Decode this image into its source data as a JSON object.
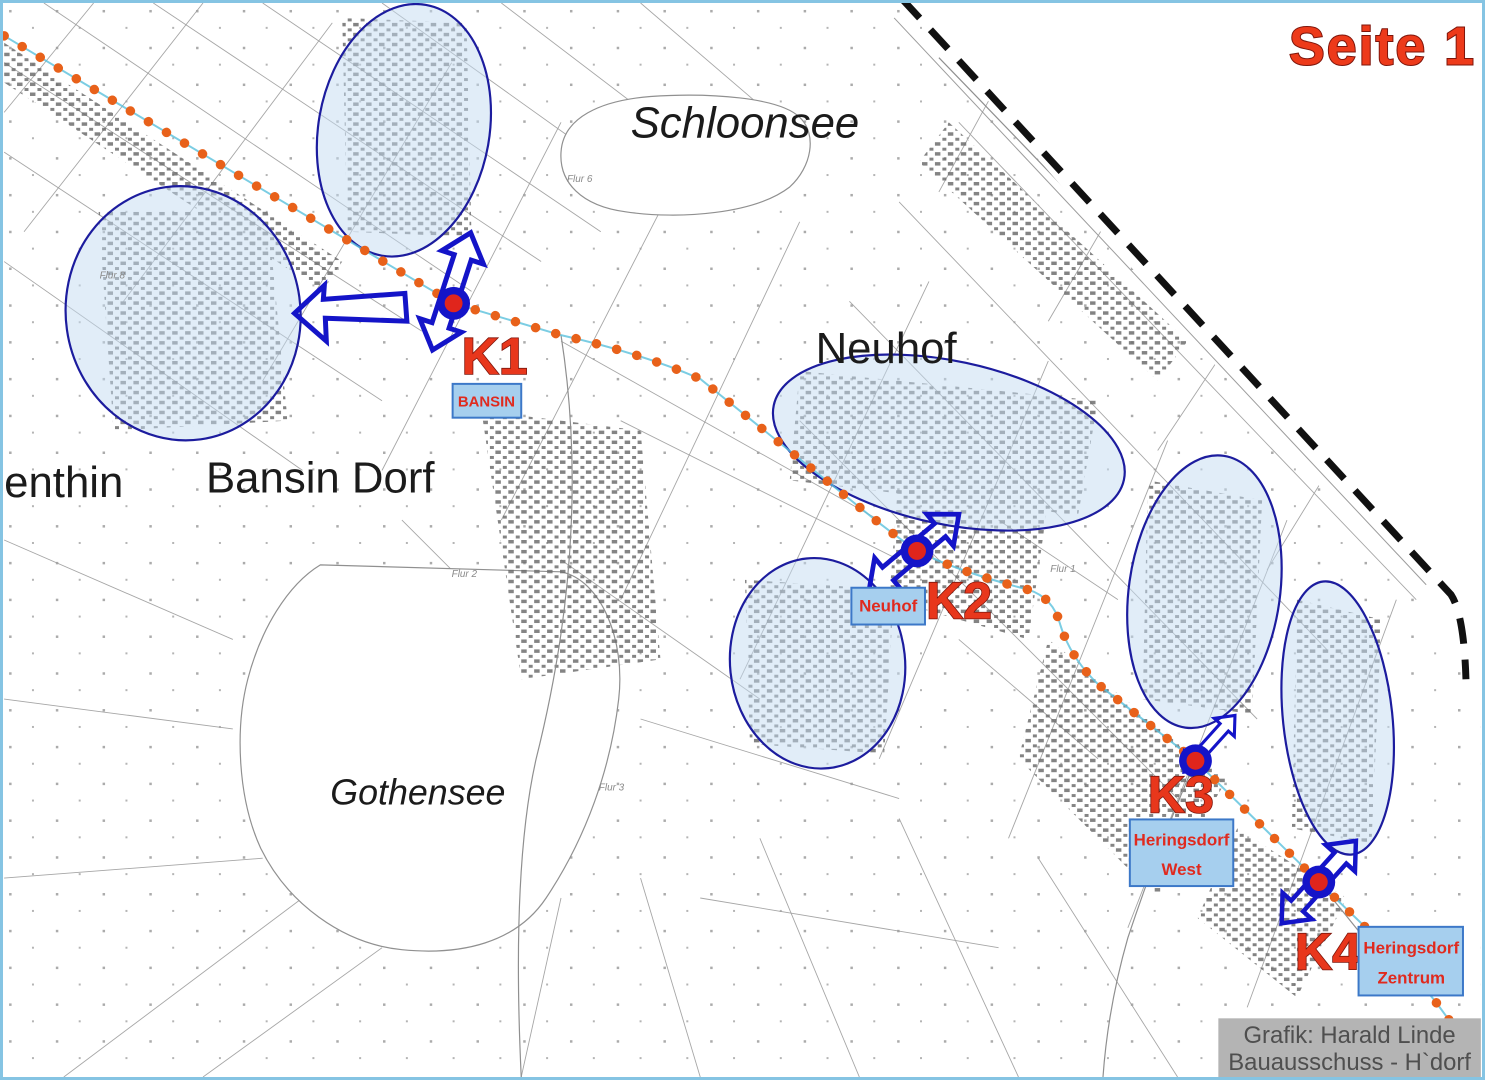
{
  "page": {
    "title": "Seite 1"
  },
  "map": {
    "place_labels": {
      "schloonsee": "Schloonsee",
      "neuhof": "Neuhof",
      "bansin_dorf": "Bansin Dorf",
      "gothensee": "Gothensee",
      "enthin": "enthin"
    },
    "small_labels": [
      "Flur 2",
      "Flur 3",
      "Flur 6",
      "Flur 8",
      "Flur 1"
    ],
    "markers": [
      {
        "id": "k1",
        "label": "K1",
        "box_lines": [
          "BANSIN"
        ]
      },
      {
        "id": "k2",
        "label": "K2",
        "box_lines": [
          "Neuhof"
        ]
      },
      {
        "id": "k3",
        "label": "K3",
        "box_lines": [
          "Heringsdorf",
          "West"
        ]
      },
      {
        "id": "k4",
        "label": "K4",
        "box_lines": [
          "Heringsdorf",
          "Zentrum"
        ]
      }
    ],
    "credit": {
      "line1": "Grafik: Harald Linde",
      "line2": "Bauausschuss - H`dorf"
    }
  },
  "colors": {
    "route_orange": "#e8611a",
    "marker_blue": "#1414c8",
    "marker_red": "#e0251c",
    "highlight_fill": "#c3dcf2",
    "highlight_border": "#1c1c9e",
    "label_box_fill": "#a6cfee",
    "label_box_border": "#3c78c8",
    "label_text_red": "#e02a1e",
    "title_red": "#ed3a1a",
    "coast_black": "#111111",
    "credit_bg": "#b4b4b4",
    "credit_text": "#4f4f4f",
    "frame_blue": "#85c4e3"
  }
}
